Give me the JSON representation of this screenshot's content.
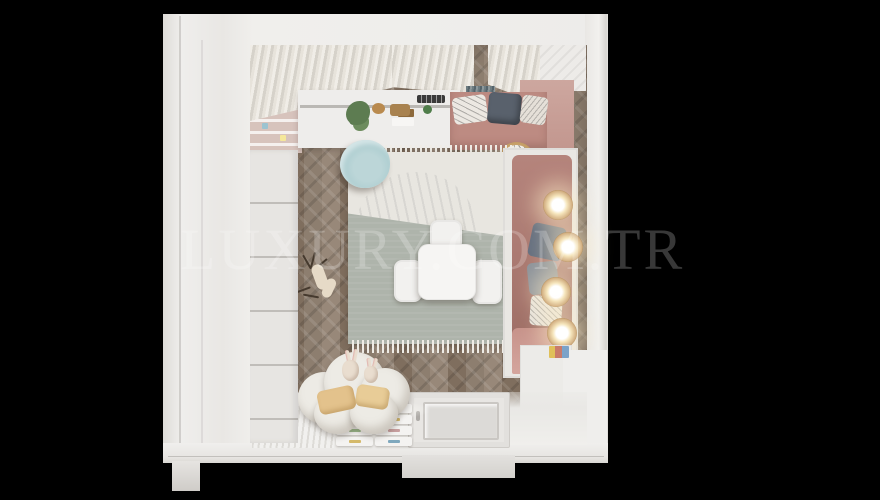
{
  "watermark": {
    "text": "LUXURY.COM.TR",
    "color": "#ffffff",
    "opacity": 0.22,
    "style": "serif, semi-transparent, centered over image"
  },
  "scene": {
    "type": "3d-render-top-down",
    "subject": "Kids bedroom interior viewed from directly above (dollhouse cutaway), white walls on black background",
    "background_color": "#000000",
    "palette": {
      "walls": "#eceae7",
      "floor_wood": "#8d7e6f",
      "rug_light": "#e8e6e0",
      "rug_sage": "#aeb4ab",
      "accent_mauve": "#b5847c",
      "accent_teal_chair": "#a9cbce",
      "curtain_cream": "#e7e3db",
      "lamp_wood": "#d2b285",
      "lamp_glow": "#fff3d6",
      "pillow_yellow": "#e3c28c",
      "pillow_slate": "#59616c"
    },
    "objects": [
      {
        "label": "pleated cream curtains along top window wall"
      },
      {
        "label": "bookshelf with small toys and books"
      },
      {
        "label": "white desk with plant, baskets and desk organizer"
      },
      {
        "label": "mauve window bench with patterned and slate pillows"
      },
      {
        "label": "round teal desk chair"
      },
      {
        "label": "fringed area rug, cream and sage green"
      },
      {
        "label": "white kids table with three chairs"
      },
      {
        "label": "rocking deer toy"
      },
      {
        "label": "bed with mauve bedding, gray pillows and pink blanket"
      },
      {
        "label": "four glowing round wooden wall lamps"
      },
      {
        "label": "rattan poufs with patterned pillows"
      },
      {
        "label": "cloud shaped bean bag with two bunny plush toys"
      },
      {
        "label": "white storage trays with folded items"
      },
      {
        "label": "white radiator"
      },
      {
        "label": "white interior door (bottom wall)"
      },
      {
        "label": "white wardrobe with drawers (left wall)"
      },
      {
        "label": "white dresser cabinet (bottom right corner)"
      }
    ]
  }
}
